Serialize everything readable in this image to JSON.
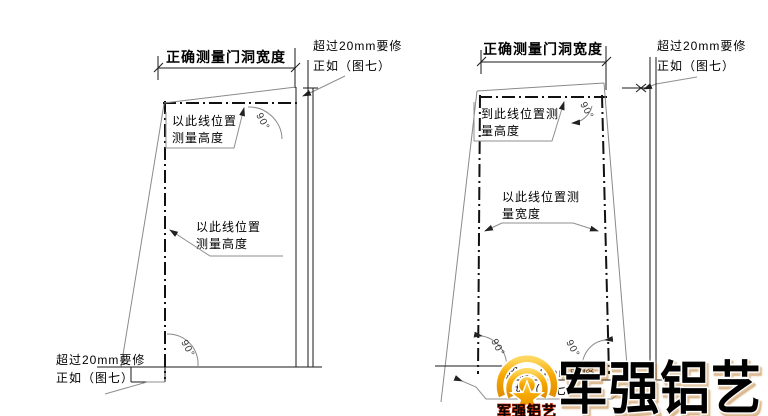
{
  "canvas": {
    "width": 768,
    "height": 416,
    "background": "#ffffff"
  },
  "colors": {
    "main_line": "#111111",
    "thin_outline": "#8a8a8a",
    "leader": "#8f8f8f",
    "text": "#000000",
    "watermark_gold": "#f6a800",
    "watermark_gold_light": "#ffd75e",
    "watermark_gold_dark": "#d88a00",
    "watermark_outline": "#ffffff",
    "logo_caption_red": "#cc2a00"
  },
  "figure_left": {
    "title": "正确测量门洞宽度",
    "top_right_note": {
      "line1": "超过20mm要修",
      "line2": "正如（图七）"
    },
    "upper_annotation": {
      "line1": "以此线位置",
      "line2": "测量高度"
    },
    "middle_annotation": {
      "line1": "以此线位置",
      "line2": "测量高度"
    },
    "bottom_left_note": {
      "line1": "超过20mm要修",
      "line2": "正如（图七）"
    },
    "top_angle_label": "90°",
    "bottom_angle_label": "90°"
  },
  "figure_right": {
    "title": "正确测量门洞宽度",
    "top_right_note": {
      "line1": "超过20mm要修",
      "line2": "正如（图七）"
    },
    "upper_annotation": {
      "line1": "到此线位置测",
      "line2": "量高度"
    },
    "middle_annotation": {
      "line1": "以此线位置测",
      "line2": "量宽度"
    },
    "bottom_note": {
      "line1": "超过20mm要修",
      "line2": "正如（图七）"
    },
    "top_angle_label": "90°",
    "bottom_left_angle_label": "90°",
    "bottom_right_angle_label": "90°"
  },
  "watermark": {
    "brand_text": "军强铝艺",
    "logo_caption": "军强铝艺"
  }
}
